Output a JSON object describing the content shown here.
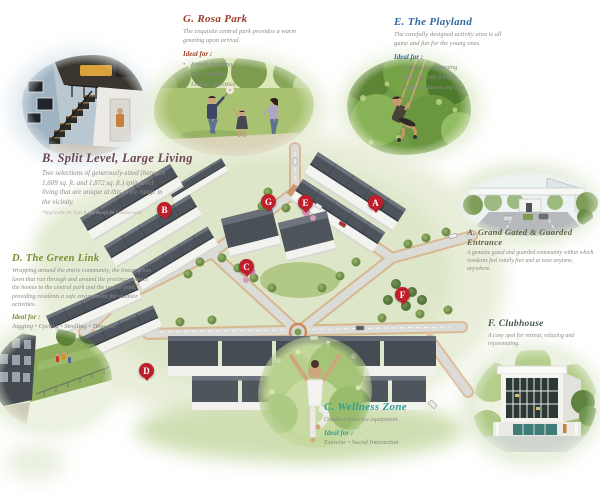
{
  "sections": {
    "rosa_park": {
      "title": "G.  Rosa Park",
      "description": "The exquisite central park provides a warm greeting upon arrival.",
      "ideal_label": "Ideal for :",
      "items": [
        "Family bonding",
        "Get-togethers",
        "Leisure activities"
      ],
      "accent": "#9e3b2a"
    },
    "playland": {
      "title": "E.  The Playland",
      "description": "The carefully designed activity area is all game and fun for the young ones.",
      "ideal_label": "Ideal for :",
      "items": [
        "Playing and learning",
        "Meeting with friends",
        "Outdoor games and fun"
      ],
      "accent": "#31689e"
    },
    "split_level": {
      "title": "B.  Split Level, Large Living",
      "description": "Two selections of generously-sized (between 1,609 sq. ft. and 1,872 sq. ft.) split-level living that are unique at this price range in the vicinity.",
      "footnote": "*Applicable for Type B and except for Goldton units",
      "accent": "#6b4757"
    },
    "green_link": {
      "title": "D.  The Green Link",
      "description": "Wrapping around the entire community, the linear green lawn that run through and around the precinct connect the homes to the central park and the pocket park, providing residents a safe environment for outdoor activities.",
      "ideal_label": "Ideal for :",
      "ideal_inline": "Jogging  •  Cycling  •  Strolling  •  Time-out",
      "accent": "#7c8b33"
    },
    "entrance": {
      "title": "A.  Grand Gated & Guarded Entrance",
      "description": "A genuine gated and guarded community within which residents feel totally free and at ease anytime, anywhere.",
      "accent": "#5d6140"
    },
    "clubhouse": {
      "title": "F. Clubhouse",
      "description": "A cosy spot for retreat, relaxing and rejuvenating.",
      "accent": "#44584b"
    },
    "wellness": {
      "title": "C. Wellness Zone",
      "description": "Outdoor exercise equipment.",
      "ideal_label": "Ideal for :",
      "ideal_inline": "Exercise  •  Social Interaction",
      "accent": "#2fa092"
    }
  },
  "markers": {
    "a": "A",
    "b": "B",
    "c": "C",
    "d": "D",
    "e": "E",
    "f": "F",
    "g": "G"
  },
  "colors": {
    "marker_red": "#c01e2b",
    "wash_green": "#dde6c8",
    "roof_gray": "#4d545c",
    "road_gray": "#dbdbd7",
    "brick_orange": "#cf8a58",
    "body_text": "#8e8b88"
  }
}
